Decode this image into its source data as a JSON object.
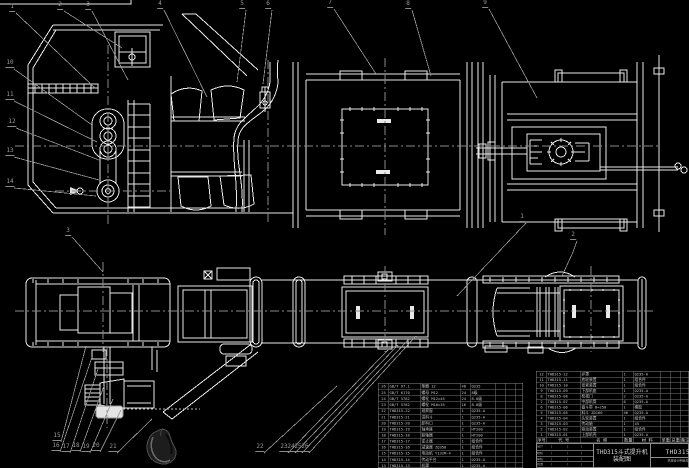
{
  "drawing": {
    "title": "THD315斗式提升机",
    "subtitle": "装配图",
    "drawing_no": "THD315-00",
    "org_line": "机械设计制造及其自动化",
    "colors": {
      "background": "#000000",
      "line": "#e9e9e9",
      "leader": "#9a9a9a",
      "table_grid": "#8d8d8d",
      "table_text": "#c6c6c6"
    }
  },
  "parts_header": [
    "序号",
    "代 号",
    "名 称",
    "数量",
    "材 料",
    "单重",
    "总重",
    "备注"
  ],
  "parts_table_right": [
    [
      "12",
      "THD315-12",
      "护罩",
      "1",
      "Q235-A",
      "",
      "",
      ""
    ],
    [
      "11",
      "THD315-11",
      "底轮装置",
      "1",
      "组合件",
      "",
      "",
      ""
    ],
    [
      "10",
      "THD315-10",
      "张紧装置",
      "1",
      "组合件",
      "",
      "",
      ""
    ],
    [
      "9",
      "THD315-09",
      "下部机座",
      "1",
      "Q235-A",
      "",
      "",
      ""
    ],
    [
      "8",
      "THD315-08",
      "检视门",
      "2",
      "Q235-A",
      "",
      "",
      ""
    ],
    [
      "7",
      "THD315-07",
      "中部机筒",
      "6",
      "Q235-A",
      "",
      "",
      ""
    ],
    [
      "6",
      "THD315-06",
      "畚斗带 B=250",
      "1",
      "橡胶",
      "",
      "",
      ""
    ],
    [
      "5",
      "THD315-05",
      "料斗 ZD160",
      "46",
      "Q235-A",
      "",
      "",
      ""
    ],
    [
      "4",
      "THD315-04",
      "头轮装置",
      "1",
      "组合件",
      "",
      "",
      ""
    ],
    [
      "3",
      "THD315-03",
      "传动轴",
      "1",
      "45",
      "",
      "",
      ""
    ],
    [
      "2",
      "THD315-02",
      "驱动装置",
      "1",
      "组合件",
      "",
      "",
      ""
    ],
    [
      "1",
      "THD315-01",
      "上部机壳",
      "1",
      "Q235-A",
      "",
      "",
      ""
    ]
  ],
  "parts_table_left": [
    [
      "26",
      "GB/T 97.1",
      "垫圈 12",
      "48",
      "Q235",
      "",
      "",
      ""
    ],
    [
      "25",
      "GB/T 6170",
      "螺母 M12",
      "24",
      "8级",
      "",
      "",
      ""
    ],
    [
      "24",
      "GB/T 5782",
      "螺栓 M12×45",
      "24",
      "8.8级",
      "",
      "",
      ""
    ],
    [
      "23",
      "GB/T 5782",
      "螺栓 M10×35",
      "16",
      "8.8级",
      "",
      "",
      ""
    ],
    [
      "22",
      "THD315-22",
      "观察窗",
      "1",
      "Q235-A",
      "",
      "",
      ""
    ],
    [
      "21",
      "THD315-21",
      "进料斗",
      "1",
      "Q235-A",
      "",
      "",
      ""
    ],
    [
      "20",
      "THD315-20",
      "卸料口",
      "1",
      "Q235-A",
      "",
      "",
      ""
    ],
    [
      "19",
      "THD315-19",
      "轴承座",
      "2",
      "HT200",
      "",
      "",
      ""
    ],
    [
      "18",
      "THD315-18",
      "联轴器",
      "1",
      "HT200",
      "",
      "",
      ""
    ],
    [
      "17",
      "THD315-17",
      "逆止器",
      "1",
      "组合件",
      "",
      "",
      ""
    ],
    [
      "16",
      "THD315-16",
      "减速器 ZQ350",
      "1",
      "组合件",
      "",
      "",
      ""
    ],
    [
      "15",
      "THD315-15",
      "电动机 Y132M-4",
      "1",
      "组合件",
      "",
      "",
      ""
    ],
    [
      "14",
      "THD315-14",
      "传动平台",
      "1",
      "Q235-A",
      "",
      "",
      ""
    ],
    [
      "13",
      "THD315-13",
      "机罩",
      "1",
      "Q235-A",
      "",
      "",
      ""
    ]
  ],
  "signature_rows": [
    [
      "设计",
      "",
      "",
      ""
    ],
    [
      "校核",
      "",
      "",
      ""
    ],
    [
      "审核",
      "",
      "",
      ""
    ],
    [
      "批准",
      "",
      "",
      ""
    ]
  ],
  "balloons": [
    {
      "n": "1",
      "x": 12,
      "y": 12,
      "ex": 95,
      "ey": 88
    },
    {
      "n": "2",
      "x": 60,
      "y": 10,
      "ex": 122,
      "ey": 48
    },
    {
      "n": "3",
      "x": 88,
      "y": 10,
      "ex": 128,
      "ey": 80
    },
    {
      "n": "4",
      "x": 160,
      "y": 9,
      "ex": 207,
      "ey": 97
    },
    {
      "n": "5",
      "x": 242,
      "y": 9,
      "ex": 237,
      "ey": 82
    },
    {
      "n": "6",
      "x": 268,
      "y": 9,
      "ex": 263,
      "ey": 84
    },
    {
      "n": "7",
      "x": 330,
      "y": 8,
      "ex": 376,
      "ey": 74
    },
    {
      "n": "8",
      "x": 408,
      "y": 9,
      "ex": 431,
      "ey": 76
    },
    {
      "n": "9",
      "x": 485,
      "y": 8,
      "ex": 537,
      "ey": 98
    },
    {
      "n": "10",
      "x": 10,
      "y": 68,
      "ex": 92,
      "ey": 125
    },
    {
      "n": "11",
      "x": 10,
      "y": 100,
      "ex": 97,
      "ey": 142
    },
    {
      "n": "12",
      "x": 12,
      "y": 127,
      "ex": 99,
      "ey": 160
    },
    {
      "n": "13",
      "x": 10,
      "y": 156,
      "ex": 99,
      "ey": 180
    },
    {
      "n": "14",
      "x": 10,
      "y": 187,
      "ex": 96,
      "ey": 196
    },
    {
      "n": "15",
      "x": 57,
      "y": 441,
      "ex": 86,
      "ey": 346
    },
    {
      "n": "16",
      "x": 56,
      "y": 451,
      "ex": 92,
      "ey": 357
    },
    {
      "n": "17",
      "x": 66,
      "y": 452,
      "ex": 98,
      "ey": 369
    },
    {
      "n": "18",
      "x": 76,
      "y": 451,
      "ex": 104,
      "ey": 386
    },
    {
      "n": "19",
      "x": 86,
      "y": 452,
      "ex": 113,
      "ey": 399
    },
    {
      "n": "20",
      "x": 96,
      "y": 451,
      "ex": 121,
      "ey": 410
    },
    {
      "n": "21",
      "x": 113,
      "y": 452,
      "ex": 152,
      "ey": 419
    },
    {
      "n": "22",
      "x": 260,
      "y": 452,
      "ex": 337,
      "ey": 386
    },
    {
      "n": "23",
      "x": 284,
      "y": 452,
      "ex": 388,
      "ey": 350
    },
    {
      "n": "24",
      "x": 291,
      "y": 452,
      "ex": 398,
      "ey": 345
    },
    {
      "n": "25",
      "x": 298,
      "y": 452,
      "ex": 408,
      "ey": 340
    },
    {
      "n": "26",
      "x": 305,
      "y": 452,
      "ex": 416,
      "ey": 336
    },
    {
      "n": "2",
      "x": 573,
      "y": 240,
      "mx": 573,
      "my": 252,
      "ex": 562,
      "ey": 276
    },
    {
      "n": "1",
      "x": 522,
      "y": 222,
      "ex": 457,
      "ey": 296
    },
    {
      "n": "3",
      "x": 68,
      "y": 236,
      "ex": 103,
      "ey": 272
    }
  ]
}
